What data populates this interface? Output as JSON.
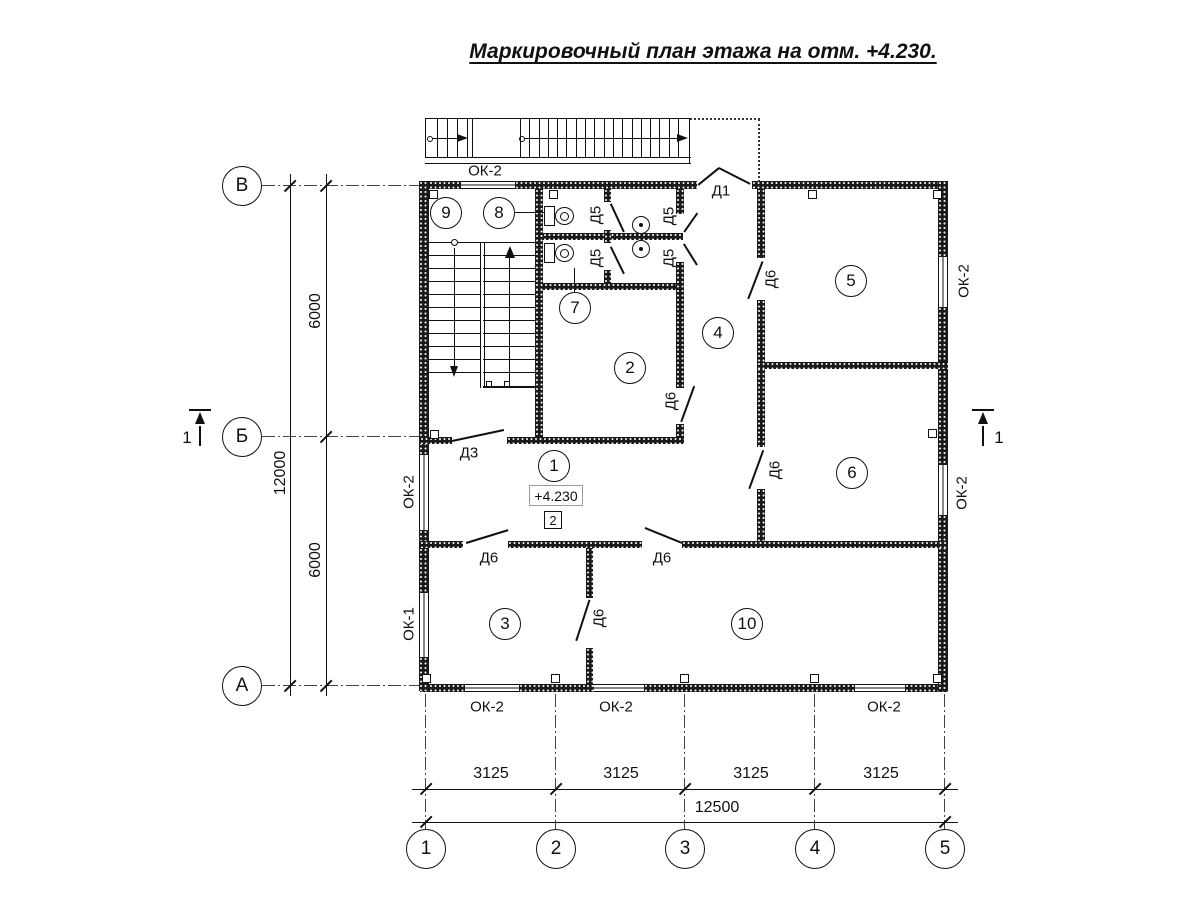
{
  "title": "Маркировочный план этажа на отм. +4.230.",
  "axes": {
    "cols": [
      "1",
      "2",
      "3",
      "4",
      "5"
    ],
    "rows": [
      "В",
      "Б",
      "А"
    ]
  },
  "dims": {
    "col_segments": [
      "3125",
      "3125",
      "3125",
      "3125"
    ],
    "col_total": "12500",
    "row_segments": [
      "6000",
      "6000"
    ],
    "row_total": "12000"
  },
  "rooms": {
    "r1": "1",
    "r2": "2",
    "r3": "3",
    "r4": "4",
    "r5": "5",
    "r6": "6",
    "r7": "7",
    "r8": "8",
    "r9": "9",
    "r10": "10"
  },
  "marks": {
    "d1": "Д1",
    "d3": "Д3",
    "d5": "Д5",
    "d6": "Д6",
    "ok1": "ОК-1",
    "ok2": "ОК-2"
  },
  "elevation": "+4.230",
  "node_marker": "2",
  "section_mark": "1",
  "colors": {
    "ink": "#111111",
    "paper": "#ffffff"
  }
}
